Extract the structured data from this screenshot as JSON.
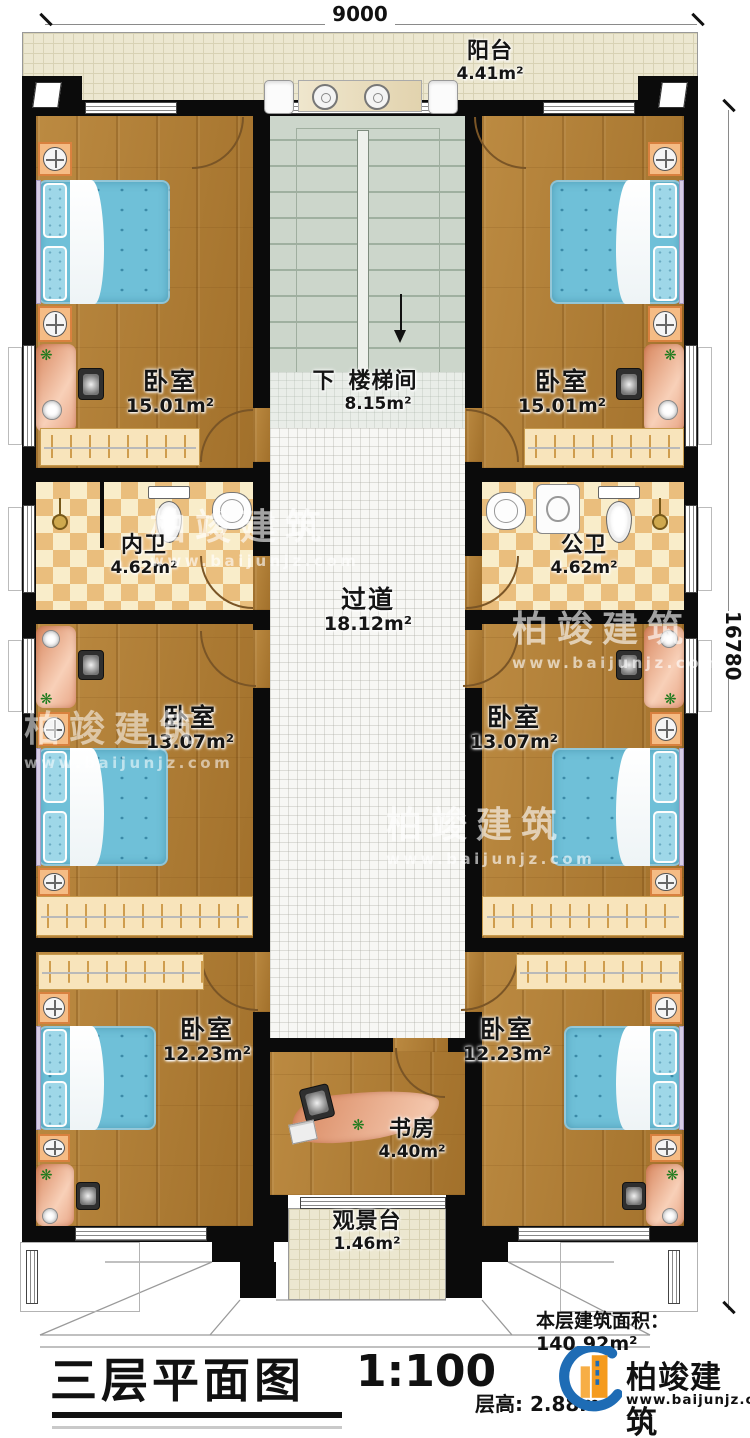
{
  "dimensions": {
    "width": "9000",
    "height": "16780"
  },
  "rooms": {
    "balcony": {
      "label": "阳台",
      "area": "4.41m²"
    },
    "bedroom_top_left": {
      "label": "卧室",
      "area": "15.01m²"
    },
    "bedroom_top_right": {
      "label": "卧室",
      "area": "15.01m²"
    },
    "stairwell": {
      "direction": "下",
      "label": "楼梯间",
      "area": "8.15m²"
    },
    "bath_inner": {
      "label": "内卫",
      "area": "4.62m²"
    },
    "bath_public": {
      "label": "公卫",
      "area": "4.62m²"
    },
    "corridor": {
      "label": "过道",
      "area": "18.12m²"
    },
    "bedroom_mid_left": {
      "label": "卧室",
      "area": "13.07m²"
    },
    "bedroom_mid_right": {
      "label": "卧室",
      "area": "13.07m²"
    },
    "bedroom_bottom_left": {
      "label": "卧室",
      "area": "12.23m²"
    },
    "bedroom_bottom_right": {
      "label": "卧室",
      "area": "12.23m²"
    },
    "study": {
      "label": "书房",
      "area": "4.40m²"
    },
    "viewing_deck": {
      "label": "观景台",
      "area": "1.46m²"
    }
  },
  "annotations": {
    "floor_area_label": "本层建筑面积：",
    "floor_area_value": "140.92m²",
    "title": "三层平面图",
    "scale": "1:100",
    "floor_height_label": "层高:",
    "floor_height_value": "2.88m"
  },
  "branding": {
    "company": "柏竣建筑",
    "website": "www.baijunjz.com"
  },
  "colors": {
    "wall": "#0b0b0b",
    "wood": "#b07c31",
    "tile_dark": "#eabe7d",
    "bed": "#6fc0d8",
    "accent_blue": "#1e6cb5",
    "accent_orange": "#f59b1e"
  }
}
